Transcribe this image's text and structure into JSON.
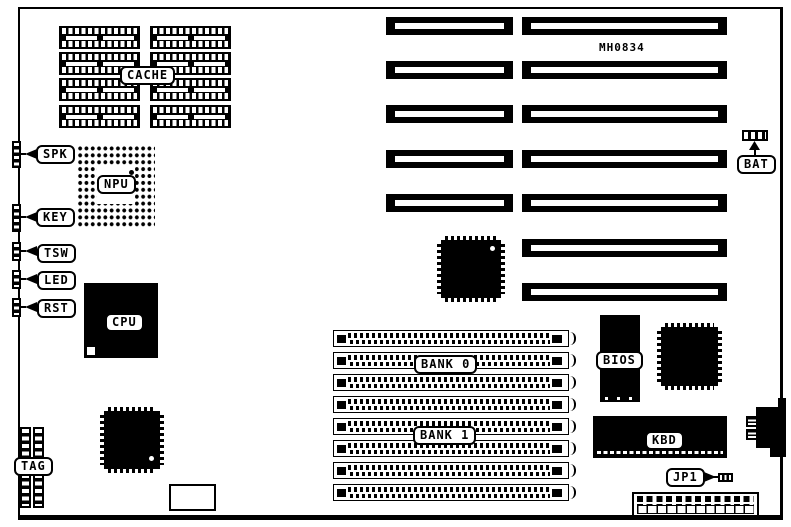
{
  "board": {
    "part_number": "MH0834",
    "component_labels": {
      "cache": "CACHE",
      "npu": "NPU",
      "cpu": "CPU",
      "spk": "SPK",
      "key": "KEY",
      "tsw": "TSW",
      "led": "LED",
      "rst": "RST",
      "tag": "TAG",
      "bank0": "BANK 0",
      "bank1": "BANK 1",
      "bios": "BIOS",
      "kbd": "KBD",
      "jp1": "JP1",
      "bat": "BAT"
    },
    "colors": {
      "ink": "#000000",
      "paper": "#ffffff"
    }
  }
}
